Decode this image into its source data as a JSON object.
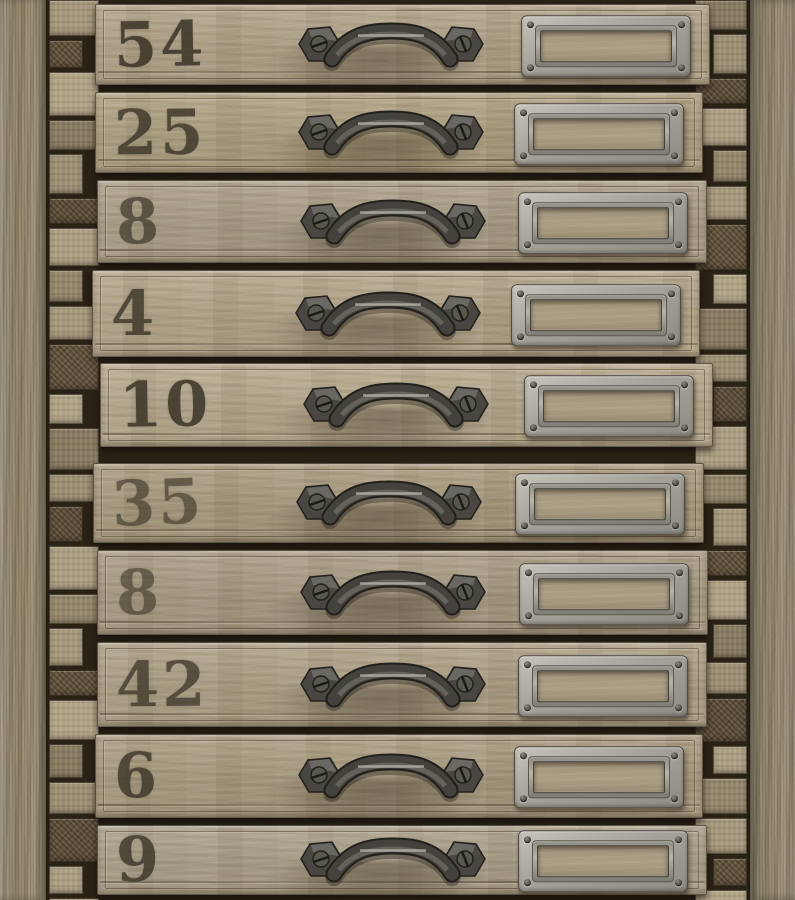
{
  "scene": {
    "subject": "Vintage wooden cabinet of ten numbered drawers, aged oak, photographic wallpaper pattern",
    "drawer_count": 10,
    "drawers": [
      {
        "number": "54"
      },
      {
        "number": "25"
      },
      {
        "number": "8"
      },
      {
        "number": "4"
      },
      {
        "number": "10"
      },
      {
        "number": "35"
      },
      {
        "number": "8"
      },
      {
        "number": "42"
      },
      {
        "number": "6"
      },
      {
        "number": "9"
      }
    ],
    "hardware": {
      "handle": "iron pull handle with two slotted screws",
      "label_holder": "silver metal card frame, empty (no label card)"
    },
    "colors": {
      "wood_light": "#b5a88c",
      "wood_mid": "#a89a7f",
      "wood_dark": "#8d8066",
      "frame_wood": "#948a72",
      "gap_shadow": "#2b2216",
      "metal_dark": "#413e39",
      "metal_light": "#b9b6af",
      "plate_silver": "#b0ada4",
      "stencil_ink": "#3a3427"
    }
  }
}
